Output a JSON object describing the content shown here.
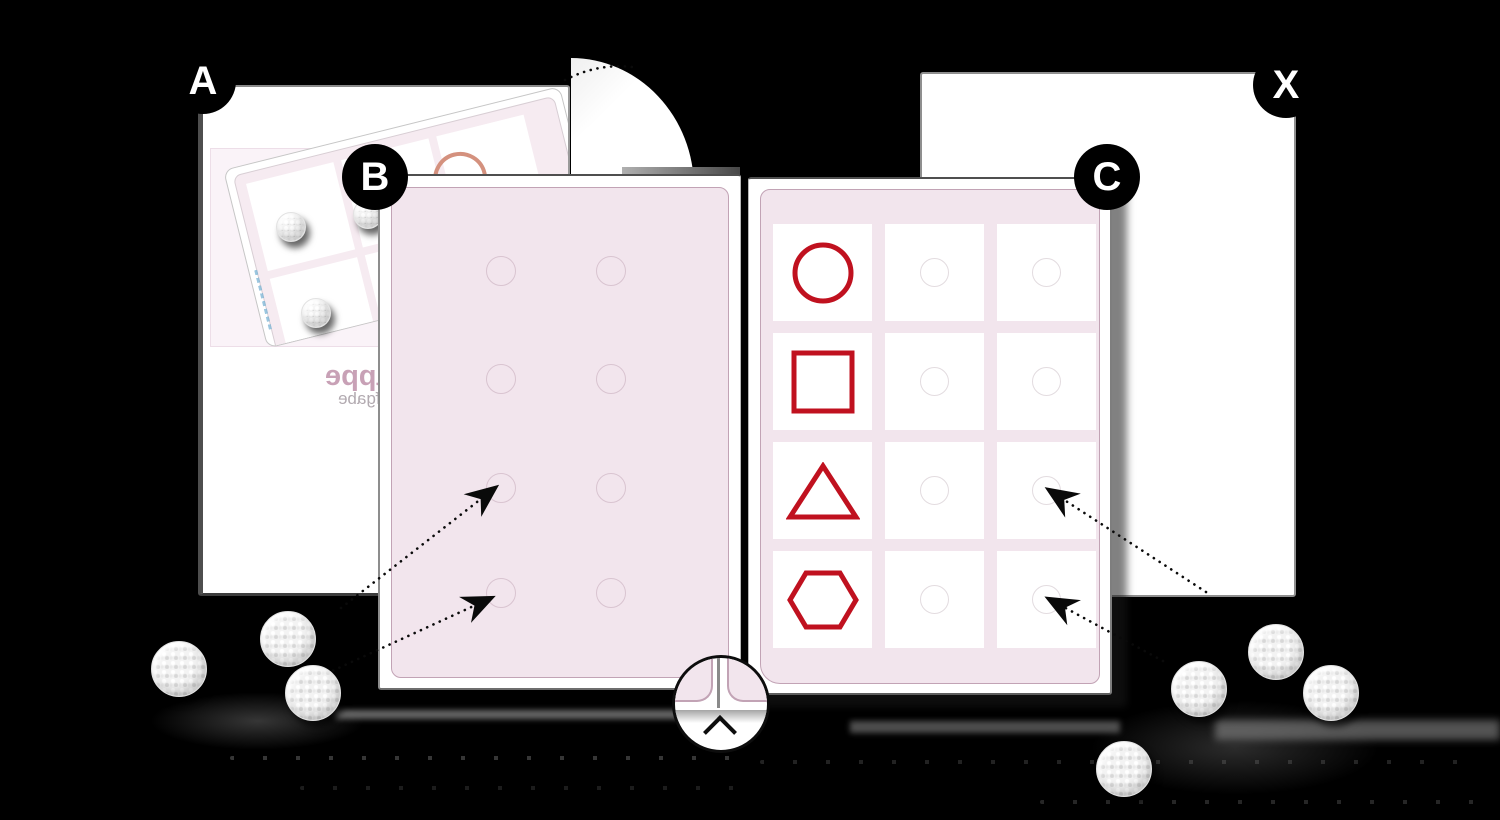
{
  "scene": {
    "background": "#000000"
  },
  "labels": {
    "step_a": "A",
    "step_b": "B",
    "step_c": "C",
    "step_x": "X"
  },
  "folder": {
    "flap_title_mirrored": "Klappe",
    "flap_subtitle_mirrored": "Aufgabe"
  },
  "shape_board": {
    "columns": 3,
    "rows": [
      {
        "shape": "circle"
      },
      {
        "shape": "square"
      },
      {
        "shape": "triangle"
      },
      {
        "shape": "hexagon"
      }
    ]
  },
  "work_board": {
    "columns": 2,
    "rows": 4
  },
  "magnifier": {
    "icon": "chevron-up"
  },
  "velcro": {
    "left_count": 3,
    "right_count": 4,
    "card_count": 3
  },
  "colors": {
    "shape_red": "#c0111f",
    "panel_pink": "#f2e5ed",
    "panel_border": "#c2a3b5",
    "flap_title": "#c8a1b6",
    "flap_subtitle": "#b2aab0",
    "salmon_circle": "#d4917e",
    "label_bg": "#000000",
    "label_fg": "#ffffff"
  }
}
